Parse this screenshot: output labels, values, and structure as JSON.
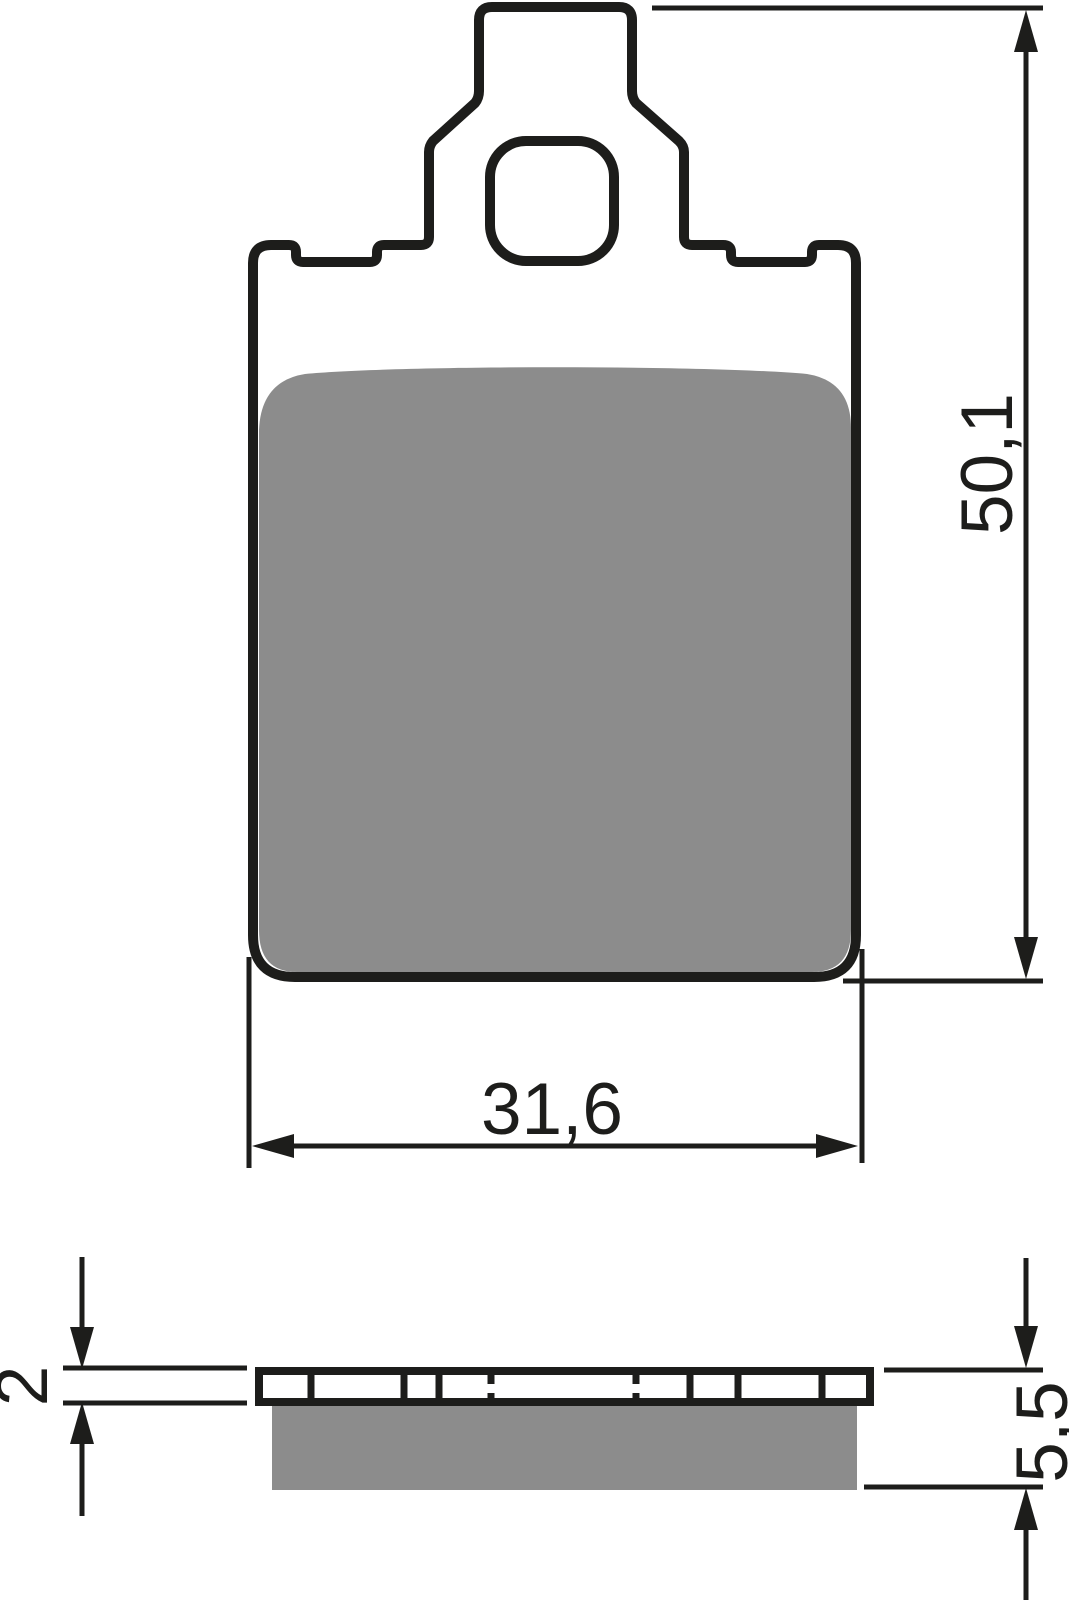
{
  "title": "Brake pad technical drawing, two views with dimensions",
  "colors": {
    "line": "#1d1d1b",
    "friction": "#8c8c8c",
    "background": "#ffffff"
  },
  "views": {
    "front": {
      "name": "front view",
      "features": [
        "pad body",
        "friction material",
        "mounting tab",
        "mounting hole",
        "left top notch",
        "right top notch"
      ]
    },
    "side": {
      "name": "side cross-section view",
      "features": [
        "segmented backplate",
        "friction material layer"
      ]
    }
  },
  "dimensions": {
    "height": {
      "label": "50,1",
      "measures": "overall height incl. tab"
    },
    "width": {
      "label": "31,6",
      "measures": "pad body width"
    },
    "backplate_thickness": {
      "label": "2",
      "measures": "backplate thickness"
    },
    "total_thickness": {
      "label": "5,5",
      "measures": "total pad thickness"
    }
  }
}
